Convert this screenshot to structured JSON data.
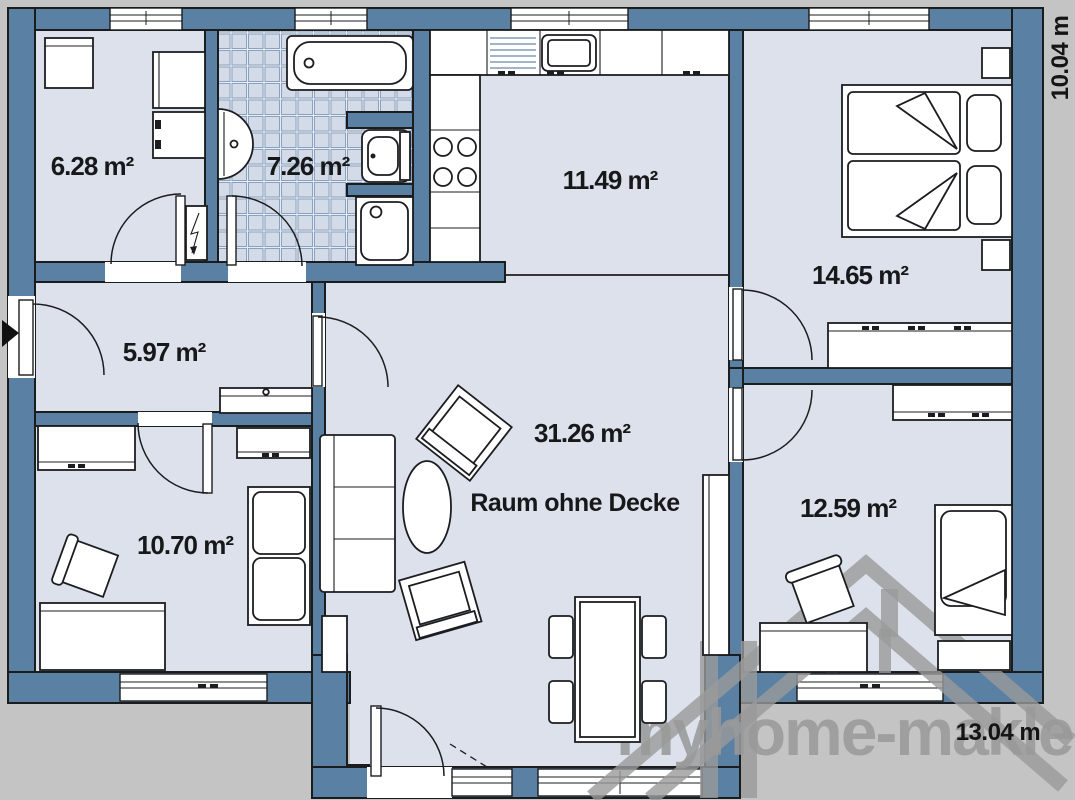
{
  "plan": {
    "rooms": [
      {
        "id": "utility-room",
        "area": "6.28 m²"
      },
      {
        "id": "bathroom",
        "area": "7.26 m²"
      },
      {
        "id": "kitchen",
        "area": "11.49 m²"
      },
      {
        "id": "bedroom",
        "area": "14.65 m²"
      },
      {
        "id": "hallway",
        "area": "5.97 m²"
      },
      {
        "id": "living-room",
        "area": "31.26 m²",
        "note": "Raum ohne Decke"
      },
      {
        "id": "room-bottom-left",
        "area": "10.70 m²"
      },
      {
        "id": "room-bottom-right",
        "area": "12.59 m²"
      }
    ],
    "dimensions": {
      "vertical": "10.04 m",
      "horizontal": "13.04 m"
    }
  },
  "watermark": {
    "brand": "myhome-makler"
  },
  "colors": {
    "wall": "#5a80a3",
    "floor": "#dce1ec",
    "background": "#c4c4c4",
    "watermark": "#9a9a9a",
    "outline": "#1b1c1e"
  }
}
